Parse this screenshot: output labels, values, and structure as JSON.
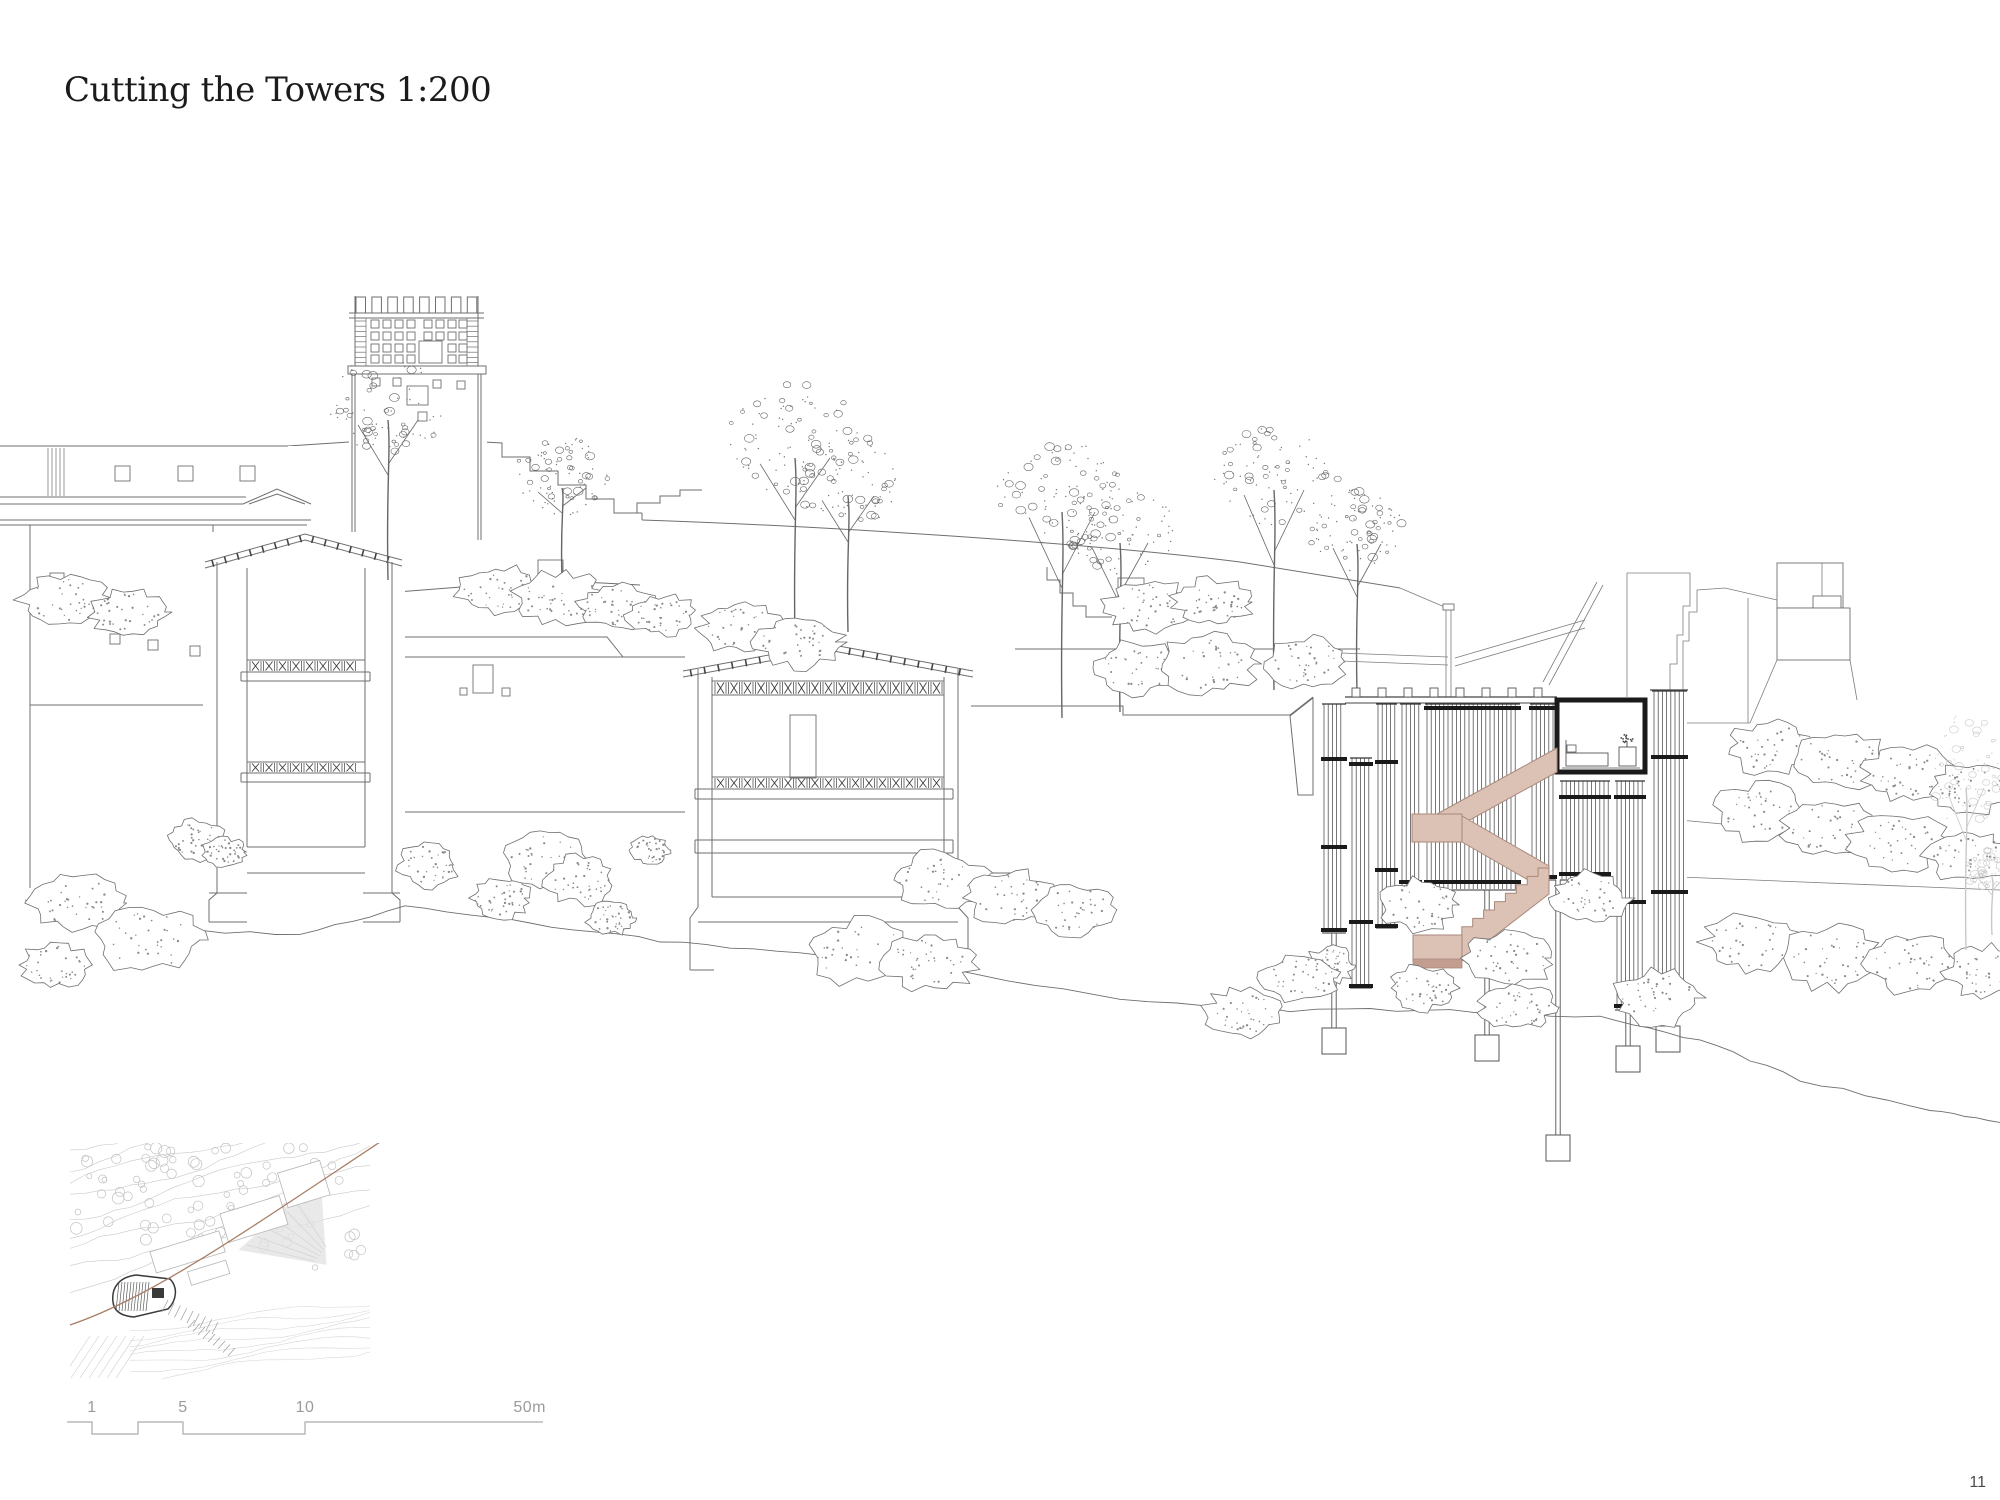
{
  "page": {
    "title": "Cutting the Towers 1:200",
    "page_number": "11"
  },
  "scale_bar": {
    "labels": [
      "1",
      "5",
      "10",
      "50m"
    ]
  },
  "colors": {
    "background": "#ffffff",
    "linework": "#6f6f6f",
    "linework_light": "#9a9a9a",
    "cut_black": "#1a1a1a",
    "stair_fill": "#dcc1b5",
    "stair_stroke": "#a8897c",
    "stair_shadow": "#c39e90",
    "siteplan_line": "#c9c9c9",
    "siteplan_dark": "#3a3a3a",
    "section_cut_line": "#a87d63",
    "scalebar_line": "#ababab",
    "scalebar_text": "#9b9b9b",
    "page_number": "#4c4c4c"
  }
}
